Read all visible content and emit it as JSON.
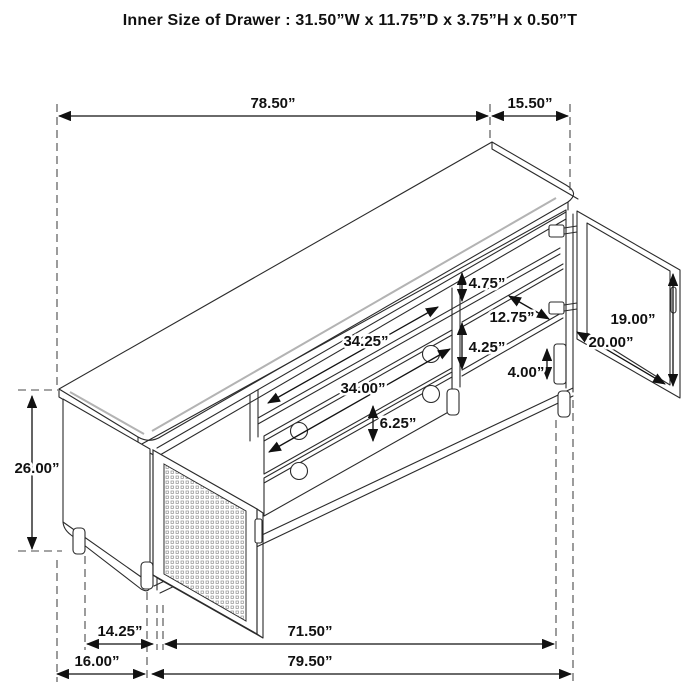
{
  "title": "Inner Size of Drawer : 31.50”W x 11.75”D x 3.75”H x 0.50”T",
  "dims": {
    "top_width": "78.50”",
    "top_depth": "15.50”",
    "upper_opening_height": "4.75”",
    "right_opening_width": "12.75”",
    "lower_opening_height": "4.25”",
    "leg_height": "4.00”",
    "right_door_height": "19.00”",
    "right_door_width": "20.00”",
    "middle_opening_width": "34.25”",
    "drawer_width": "34.00”",
    "drawer_front_height": "6.25”",
    "cabinet_height": "26.00”",
    "left_door_width": "14.25”",
    "base_width": "71.50”",
    "side_depth": "16.00”",
    "overall_width": "79.50”"
  },
  "colors": {
    "line": "#2b2b2b",
    "dash": "#4a4a4a",
    "accent": "#b3b3b3",
    "background": "#ffffff"
  }
}
